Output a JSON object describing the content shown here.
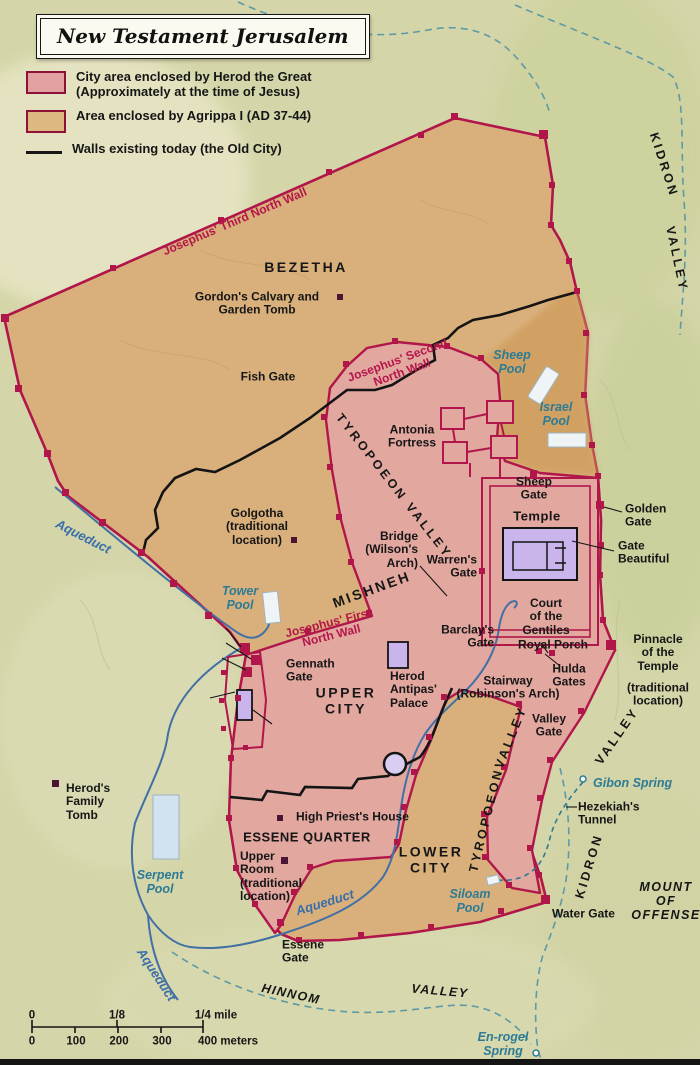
{
  "title": "New Testament Jerusalem",
  "legend": {
    "items": [
      {
        "swatch": "herod-pink-swatch",
        "label": "City area enclosed by Herod the Great\n(Approximately at the time of Jesus)"
      },
      {
        "swatch": "agrippa-tan-swatch",
        "label": "Area enclosed by Agrippa I (AD 37-44)"
      },
      {
        "swatch": "old-city-wall-line",
        "label": "Walls existing today (the Old City)"
      }
    ]
  },
  "colors": {
    "background_olive": "#d4d5a8",
    "herod_city_pink": "#e2a79f",
    "agrippa_area_tan": "#d9b07c",
    "pools_strip_tan": "#d0a061",
    "wall_crimson": "#b0164a",
    "todays_wall_black": "#141414",
    "aqueduct_blue": "#4270a5",
    "stream_teal": "#5e99a6",
    "water_label_teal": "#2d7b94",
    "temple_purple": "#c9b4ec",
    "pool_white": "#eff4f6"
  },
  "scale_bar": {
    "mile_ticks": [
      "0",
      "1/8",
      "1/4 mile"
    ],
    "meter_ticks": [
      "0",
      "100",
      "200",
      "300",
      "400 meters"
    ]
  },
  "map": {
    "labels": [
      {
        "name": "josephus-third-north-wall",
        "text": "Josephus' Third North Wall",
        "x": 235,
        "y": 222,
        "cls": "wall",
        "rot": -23
      },
      {
        "name": "bezetha",
        "text": "BEZETHA",
        "x": 306,
        "y": 268,
        "cls": "big"
      },
      {
        "name": "gordons-calvary",
        "text": "Gordon's Calvary and\nGarden Tomb",
        "x": 257,
        "y": 304
      },
      {
        "name": "fish-gate",
        "text": "Fish Gate",
        "x": 268,
        "y": 377
      },
      {
        "name": "josephus-second-north-wall",
        "text": "Josephus' Second\nNorth Wall",
        "x": 400,
        "y": 367,
        "cls": "wall",
        "rot": -20
      },
      {
        "name": "sheep-pool",
        "text": "Sheep\nPool",
        "x": 512,
        "y": 362,
        "cls": "water"
      },
      {
        "name": "israel-pool",
        "text": "Israel\nPool",
        "x": 556,
        "y": 414,
        "cls": "water"
      },
      {
        "name": "kidron-upper",
        "text": "KIDRON",
        "x": 664,
        "y": 165,
        "cls": "reg",
        "rot": 72
      },
      {
        "name": "kidron-valley-upper",
        "text": "VALLEY",
        "x": 677,
        "y": 259,
        "cls": "reg",
        "rot": 78
      },
      {
        "name": "antonia-fortress",
        "text": "Antonia\nFortress",
        "x": 412,
        "y": 437
      },
      {
        "name": "sheep-gate",
        "text": "Sheep\nGate",
        "x": 534,
        "y": 489
      },
      {
        "name": "golden-gate",
        "text": "Golden\nGate",
        "x": 625,
        "y": 516,
        "cls": "left"
      },
      {
        "name": "temple",
        "text": "Temple",
        "x": 537,
        "y": 517,
        "cls": "bld"
      },
      {
        "name": "gate-beautiful",
        "text": "Gate\nBeautiful",
        "x": 618,
        "y": 553,
        "cls": "left"
      },
      {
        "name": "court-of-the-gentiles",
        "text": "Court\nof the\nGentiles",
        "x": 546,
        "y": 617
      },
      {
        "name": "tyropoeon-valley-upper",
        "text": "TYROPOEON  VALLEY",
        "x": 394,
        "y": 486,
        "cls": "reg",
        "rot": 52
      },
      {
        "name": "golgotha",
        "text": "Golgotha\n(traditional\nlocation)",
        "x": 257,
        "y": 527
      },
      {
        "name": "aqueduct-nw",
        "text": "Aqueduct",
        "x": 83,
        "y": 537,
        "cls": "aq",
        "rot": 27
      },
      {
        "name": "tower-pool",
        "text": "Tower\nPool",
        "x": 240,
        "y": 598,
        "cls": "water"
      },
      {
        "name": "mishneh",
        "text": "MISHNEH",
        "x": 372,
        "y": 590,
        "cls": "big",
        "rot": -20
      },
      {
        "name": "bridge-wilsons-arch",
        "text": "Bridge\n(Wilson's\nArch)",
        "x": 418,
        "y": 550,
        "cls": "right"
      },
      {
        "name": "warrens-gate",
        "text": "Warren's\nGate",
        "x": 477,
        "y": 567,
        "cls": "right"
      },
      {
        "name": "josephus-first-north-wall",
        "text": "Josephus' First\nNorth Wall",
        "x": 330,
        "y": 630,
        "cls": "wall",
        "rot": -14
      },
      {
        "name": "gennath-gate",
        "text": "Gennath\nGate",
        "x": 286,
        "y": 671,
        "cls": "left"
      },
      {
        "name": "upper-city",
        "text": "UPPER\nCITY",
        "x": 346,
        "y": 701,
        "cls": "big"
      },
      {
        "name": "herod-antipas-palace",
        "text": "Herod\nAntipas'\nPalace",
        "x": 390,
        "y": 690,
        "cls": "left"
      },
      {
        "name": "barclays-gate",
        "text": "Barclay's\nGate",
        "x": 494,
        "y": 637,
        "cls": "right"
      },
      {
        "name": "royal-porch",
        "text": "Royal Porch",
        "x": 553,
        "y": 645
      },
      {
        "name": "stairway-robinsons-arch",
        "text": "Stairway\n(Robinson's Arch)",
        "x": 508,
        "y": 688
      },
      {
        "name": "hulda-gates",
        "text": "Hulda\nGates",
        "x": 569,
        "y": 676
      },
      {
        "name": "pinnacle-of-the-temple",
        "text": "Pinnacle\nof the\nTemple",
        "x": 658,
        "y": 653
      },
      {
        "name": "pinnacle-note",
        "text": "(traditional\nlocation)",
        "x": 658,
        "y": 695
      },
      {
        "name": "valley-gate",
        "text": "Valley\nGate",
        "x": 549,
        "y": 726
      },
      {
        "name": "tyropoeon-lower",
        "text": "TYROPOEON",
        "x": 486,
        "y": 820,
        "cls": "reg",
        "rot": -76
      },
      {
        "name": "tyropoeon-valley-lower",
        "text": "VALLEY",
        "x": 511,
        "y": 737,
        "cls": "reg",
        "rot": -68
      },
      {
        "name": "kidron-lower",
        "text": "KIDRON",
        "x": 589,
        "y": 866,
        "cls": "reg",
        "rot": -73
      },
      {
        "name": "kidron-valley-lower",
        "text": "VALLEY",
        "x": 617,
        "y": 736,
        "cls": "reg",
        "rot": -55
      },
      {
        "name": "gibon-spring",
        "text": "Gibon Spring",
        "x": 593,
        "y": 783,
        "cls": "water left"
      },
      {
        "name": "hezekiahs-tunnel",
        "text": "Hezekiah's\nTunnel",
        "x": 578,
        "y": 814,
        "cls": "left"
      },
      {
        "name": "herods-family-tomb",
        "text": "Herod's\nFamily\nTomb",
        "x": 66,
        "y": 802,
        "cls": "left"
      },
      {
        "name": "high-priests-house",
        "text": "High Priest's House",
        "x": 296,
        "y": 817,
        "cls": "left"
      },
      {
        "name": "essene-quarter",
        "text": "ESSENE QUARTER",
        "x": 307,
        "y": 838,
        "cls": "bld"
      },
      {
        "name": "upper-room",
        "text": "Upper\nRoom\n(traditional\nlocation)",
        "x": 240,
        "y": 877,
        "cls": "left"
      },
      {
        "name": "lower-city",
        "text": "LOWER\nCITY",
        "x": 431,
        "y": 860,
        "cls": "big"
      },
      {
        "name": "siloam-pool",
        "text": "Siloam\nPool",
        "x": 470,
        "y": 901,
        "cls": "water"
      },
      {
        "name": "water-gate",
        "text": "Water Gate",
        "x": 552,
        "y": 914,
        "cls": "left"
      },
      {
        "name": "mount-of-offense",
        "text": "MOUNT\nOF\nOFFENSE",
        "x": 666,
        "y": 901,
        "cls": "ital"
      },
      {
        "name": "essene-gate",
        "text": "Essene\nGate",
        "x": 282,
        "y": 952,
        "cls": "left"
      },
      {
        "name": "aqueduct-south",
        "text": "Aqueduct",
        "x": 325,
        "y": 903,
        "cls": "aq",
        "rot": -17
      },
      {
        "name": "aqueduct-sw",
        "text": "Aqueduct",
        "x": 156,
        "y": 975,
        "cls": "aq",
        "rot": 57
      },
      {
        "name": "hinnom",
        "text": "HINNOM",
        "x": 291,
        "y": 994,
        "cls": "ital",
        "rot": 12
      },
      {
        "name": "hinnom-valley",
        "text": "VALLEY",
        "x": 440,
        "y": 991,
        "cls": "ital",
        "rot": 5
      },
      {
        "name": "en-rogel-spring",
        "text": "En-rogel\nSpring",
        "x": 503,
        "y": 1044,
        "cls": "water"
      },
      {
        "name": "serpent-pool",
        "text": "Serpent\nPool",
        "x": 160,
        "y": 882,
        "cls": "water"
      },
      {
        "name": "scale-mile-0",
        "text": "0",
        "x": 32,
        "y": 1016,
        "cls": "sm"
      },
      {
        "name": "scale-mile-eighth",
        "text": "1/8",
        "x": 117,
        "y": 1016,
        "cls": "sm"
      },
      {
        "name": "scale-mile-quarter",
        "text": "1/4 mile",
        "x": 216,
        "y": 1016,
        "cls": "sm"
      },
      {
        "name": "scale-meter-0",
        "text": "0",
        "x": 32,
        "y": 1042,
        "cls": "sm"
      },
      {
        "name": "scale-meter-100",
        "text": "100",
        "x": 76,
        "y": 1042,
        "cls": "sm"
      },
      {
        "name": "scale-meter-200",
        "text": "200",
        "x": 119,
        "y": 1042,
        "cls": "sm"
      },
      {
        "name": "scale-meter-300",
        "text": "300",
        "x": 162,
        "y": 1042,
        "cls": "sm"
      },
      {
        "name": "scale-meter-400",
        "text": "400 meters",
        "x": 228,
        "y": 1042,
        "cls": "sm"
      }
    ]
  }
}
